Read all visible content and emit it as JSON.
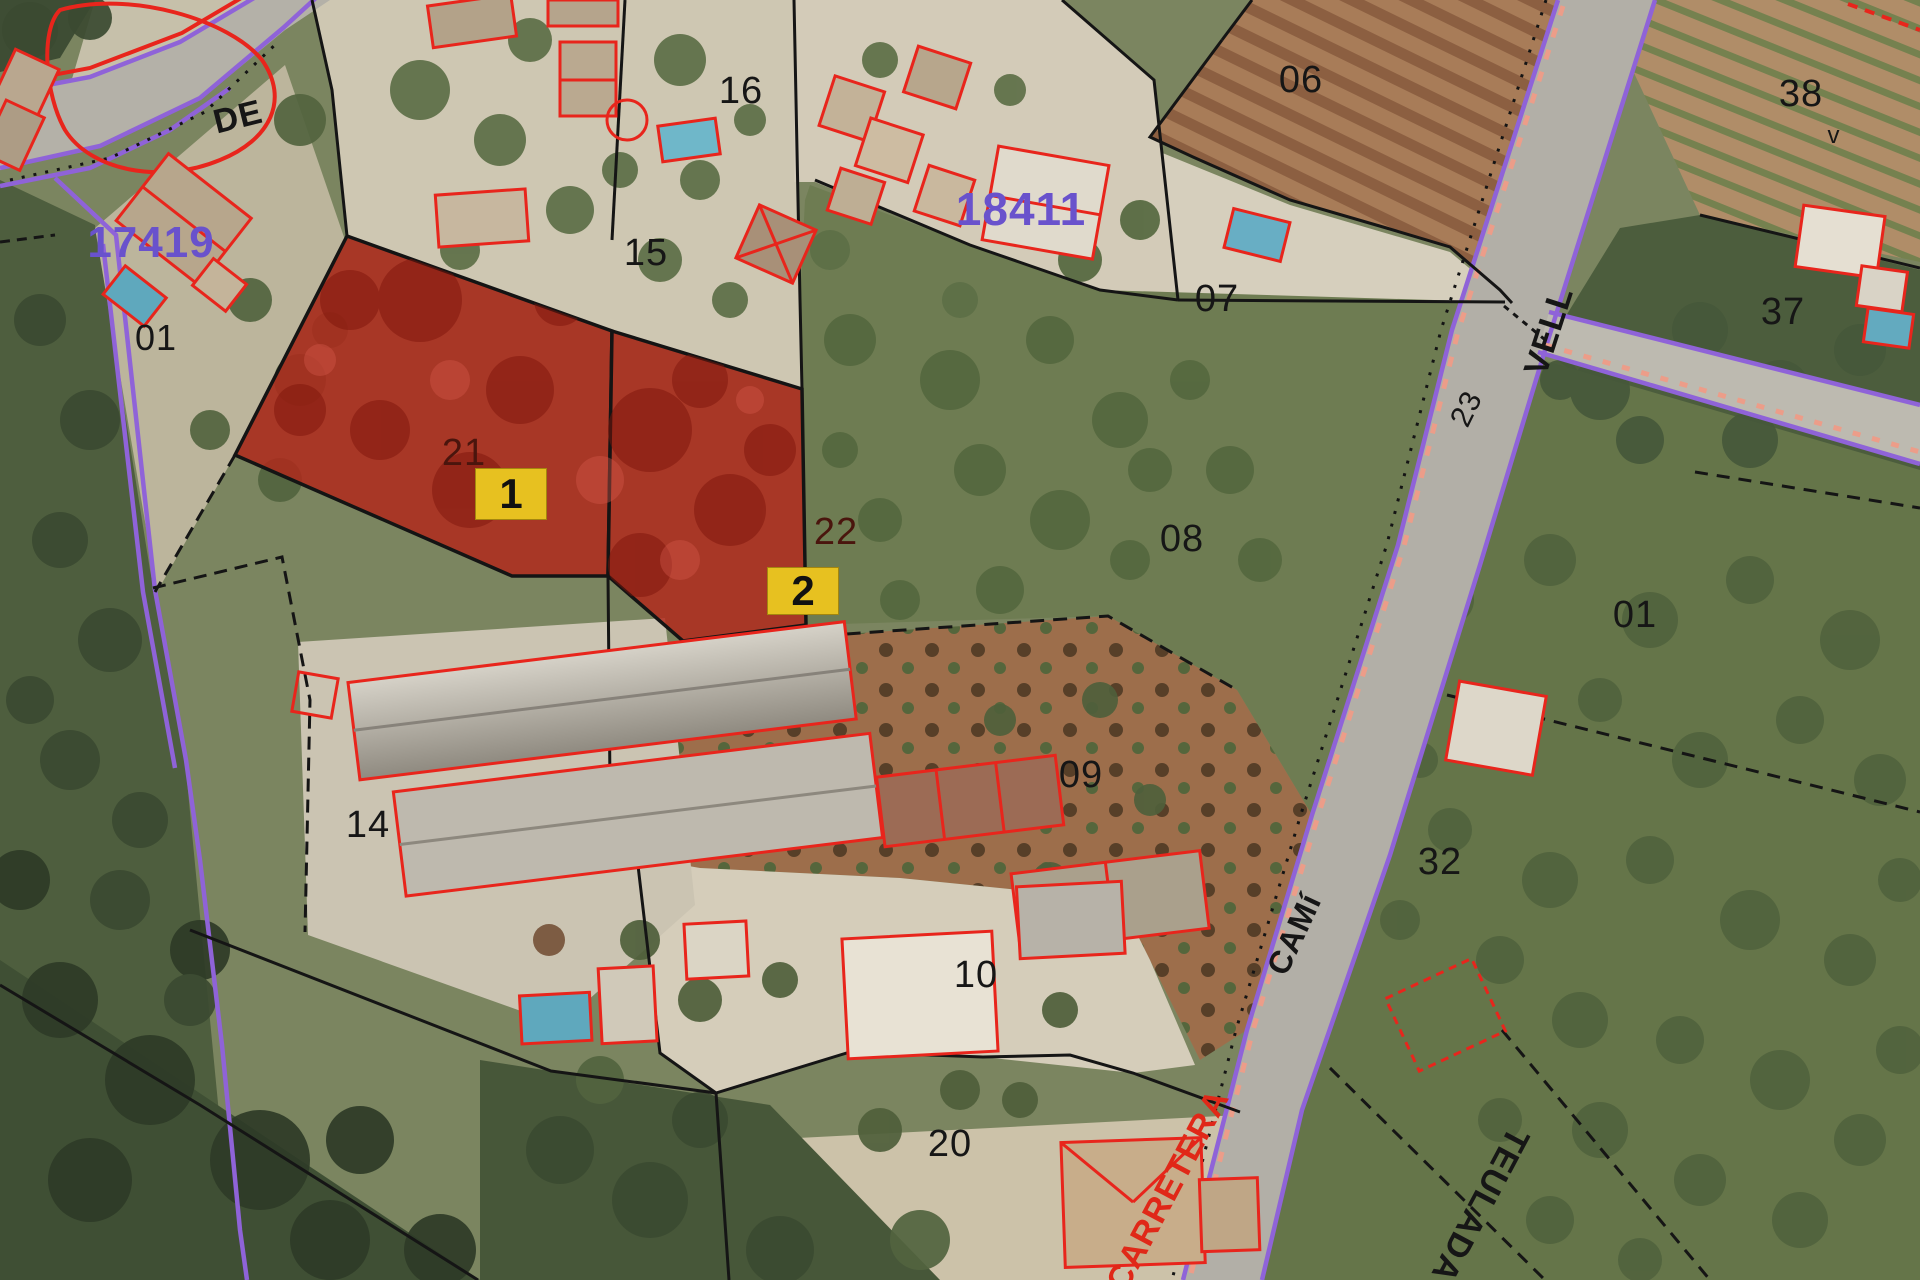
{
  "map": {
    "kind": "cadastral-aerial-viewer",
    "zone_codes": {
      "z18411": "18411",
      "z17419": "17419"
    },
    "parcels": {
      "p16": "16",
      "p15": "15",
      "p06": "06",
      "p07": "07",
      "p08": "08",
      "p09": "09",
      "p10": "10",
      "p14": "14",
      "p20": "20",
      "p32": "32",
      "p37": "37",
      "p38": "38",
      "p38v": "v",
      "p01_right": "01",
      "p01_left": "01",
      "p21": "21",
      "p22": "22",
      "p23": "23"
    },
    "road_labels": {
      "de": "DE",
      "vell": "VELL",
      "cami": "CAMí",
      "carretera": "CARRETERA",
      "teulada": "TEULADA"
    },
    "selection": {
      "badge1": "1",
      "badge2": "2"
    },
    "colors": {
      "highlight_fill": "#b0291c",
      "badge_bg": "#e7c120",
      "zone_text": "#6952cc",
      "carretera_text": "#e02818",
      "boundary": "#151515",
      "utility_line": "#8f63d8",
      "building_outline": "#e8251c"
    }
  }
}
